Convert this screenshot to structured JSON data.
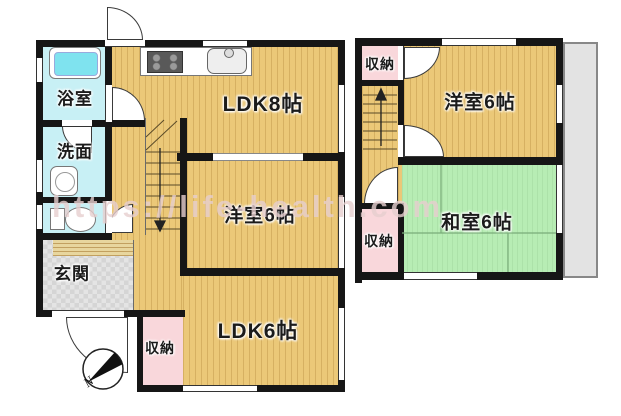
{
  "title": "間取り図",
  "watermark": "https://life-health.com",
  "floor1": {
    "rooms": {
      "bath": "浴室",
      "washroom": "洗面",
      "entrance": "玄関",
      "ldk8": "LDK8帖",
      "western6": "洋室6帖",
      "ldk6": "LDK6帖",
      "storage": "収納"
    },
    "compass": "N"
  },
  "floor2": {
    "rooms": {
      "storage_top": "収納",
      "western6": "洋室6帖",
      "japanese6": "和室6帖",
      "storage_bottom": "収納"
    }
  },
  "colors": {
    "wall": "#161616",
    "wood_floor": "#ebc878",
    "tatami": "#b7edb4",
    "water_rooms": "#c8f0f5",
    "storage": "#f9d7db",
    "entrance_floor": "#dedede",
    "balcony": "#e3e3e3",
    "bathtub": "#7fe3ef"
  }
}
